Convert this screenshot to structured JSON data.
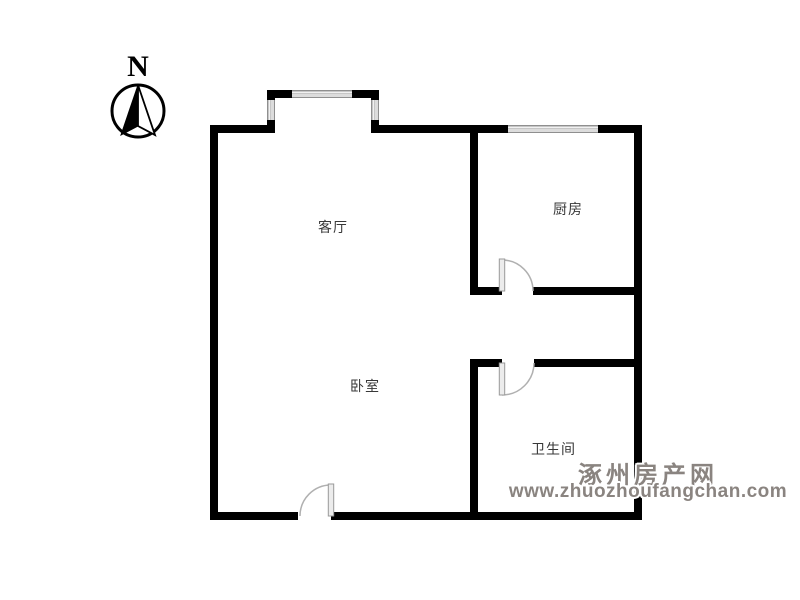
{
  "compass": {
    "label": "N"
  },
  "rooms": [
    {
      "id": "living-room",
      "label": "客厅"
    },
    {
      "id": "kitchen",
      "label": "厨房"
    },
    {
      "id": "bedroom",
      "label": "卧室"
    },
    {
      "id": "bathroom",
      "label": "卫生间"
    }
  ],
  "watermark": {
    "site_name": "涿州房产网",
    "url": "www.zhuozhoufangchan.com"
  },
  "colors": {
    "background": "#ffffff",
    "wall": "#000000",
    "window_fill": "#c6c6c6",
    "door_line": "#b0b0b0",
    "door_leaf": "#ececec",
    "label_text": "#383838",
    "watermark_text": "#8a8480"
  }
}
